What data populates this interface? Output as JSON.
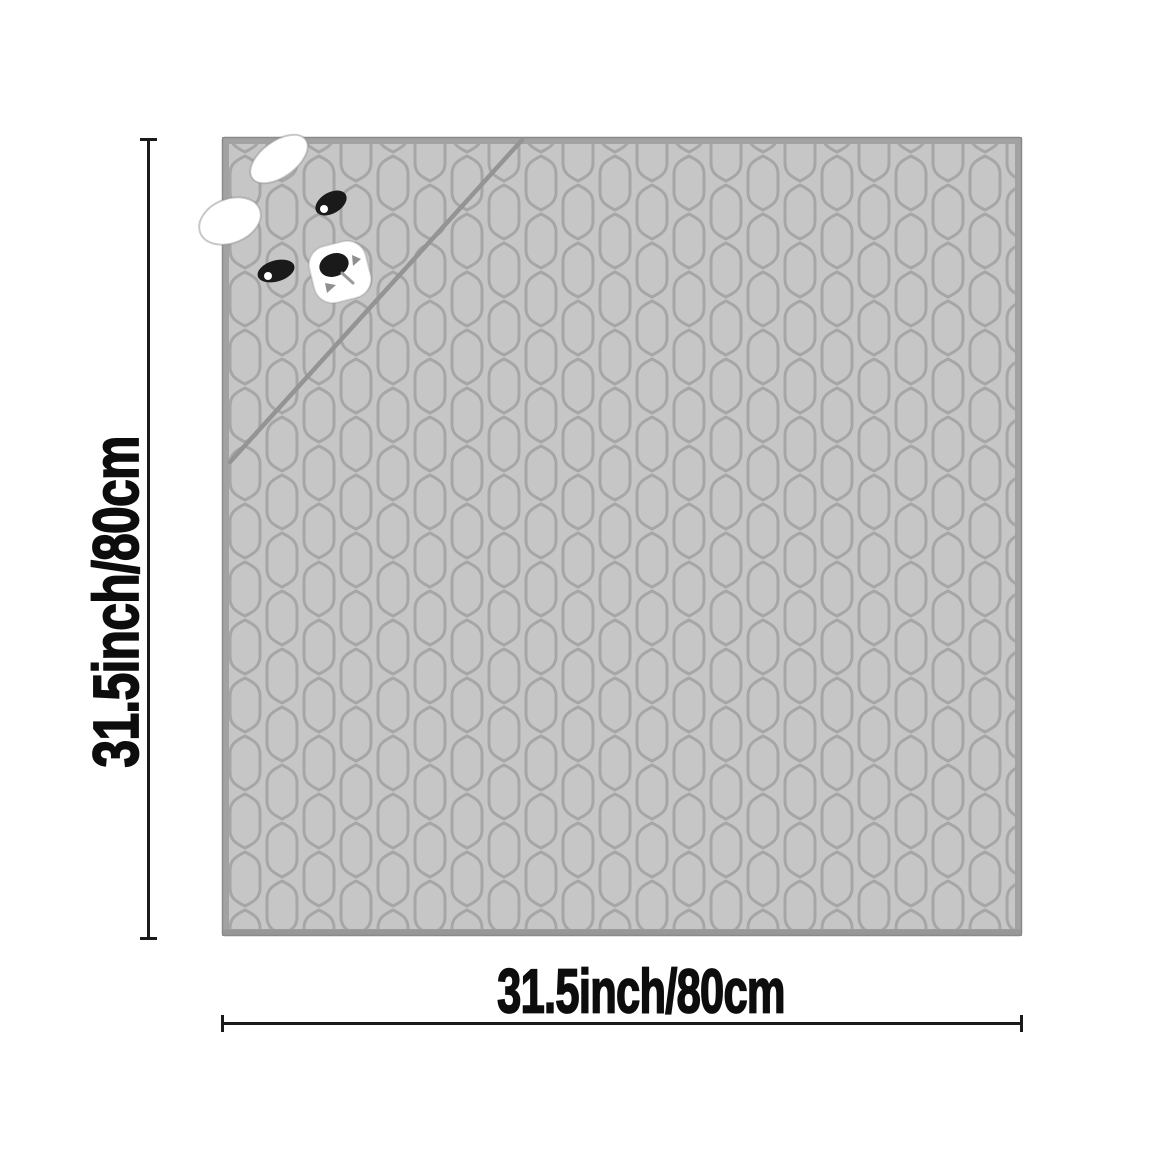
{
  "dimensions": {
    "height": {
      "label": "31.5inch/80cm"
    },
    "width": {
      "label": "31.5inch/80cm"
    }
  },
  "colors": {
    "background": "#FFFFFF",
    "mat_fill": "#C6C6C6",
    "mat_border_band": "#A2A2A2",
    "mat_edge": "#8A8A8A",
    "mat_bottom_shade": "#979797",
    "pattern_line": "#A6A6A6",
    "flap_seam": "#949494",
    "dimension_line": "#1A1A1A",
    "label_text": "#0D0D0D",
    "face_white": "#FFFFFF",
    "face_black": "#1A1A1A",
    "mouth_mark": "#8F8F8F",
    "philtrum": "#9A9A9A"
  }
}
